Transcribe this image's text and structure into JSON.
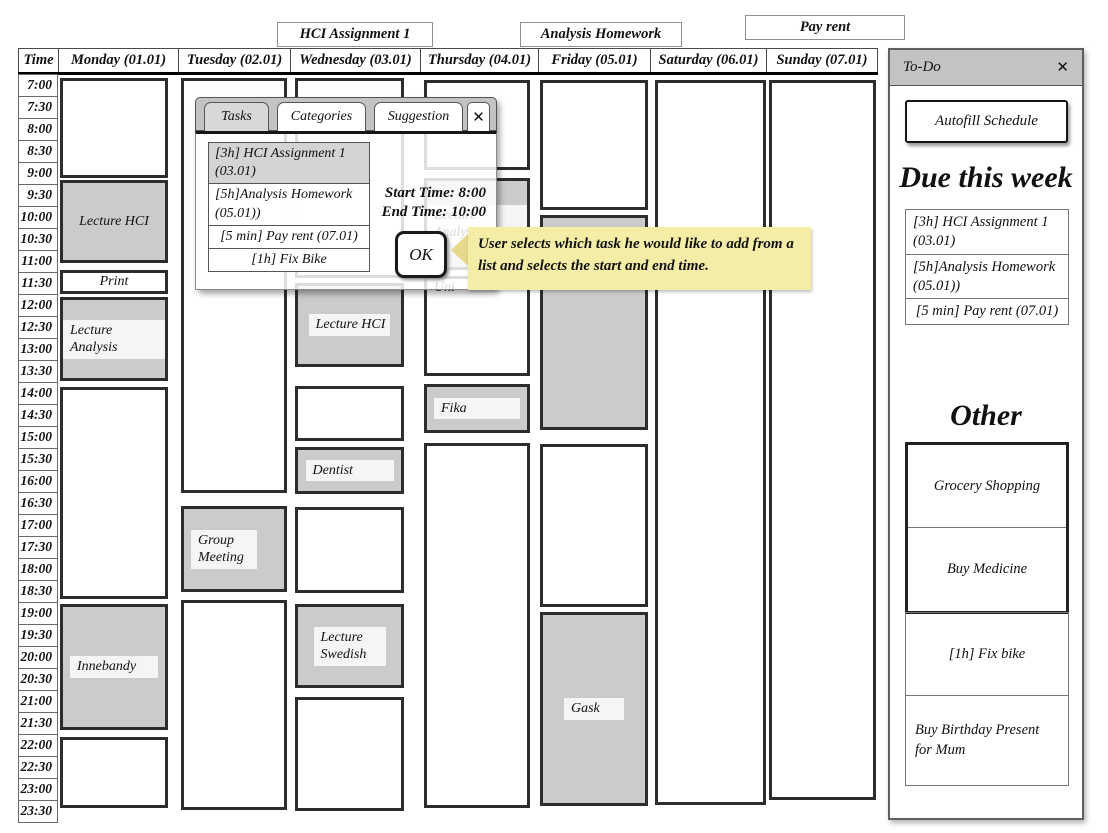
{
  "floating_labels": [
    {
      "text": "HCI Assignment 1"
    },
    {
      "text": "Analysis Homework"
    },
    {
      "text": "Pay rent"
    }
  ],
  "calendar": {
    "time_header": "Time",
    "day_headers": [
      "Monday (01.01)",
      "Tuesday (02.01)",
      "Wednesday (03.01)",
      "Thursday (04.01)",
      "Friday (05.01)",
      "Saturday (06.01)",
      "Sunday (07.01)"
    ],
    "times": [
      "7:00",
      "7:30",
      "8:00",
      "8:30",
      "9:00",
      "9:30",
      "10:00",
      "10:30",
      "11:00",
      "11:30",
      "12:00",
      "12:30",
      "13:00",
      "13:30",
      "14:00",
      "14:30",
      "15:00",
      "15:30",
      "16:00",
      "16:30",
      "17:00",
      "17:30",
      "18:00",
      "18:30",
      "19:00",
      "19:30",
      "20:00",
      "20:30",
      "21:00",
      "21:30",
      "22:00",
      "22:30",
      "23:00",
      "23:30"
    ],
    "events": [
      {
        "col": 0,
        "top": 78,
        "height": 100,
        "kind": "free"
      },
      {
        "col": 0,
        "top": 180,
        "height": 83,
        "kind": "busy",
        "label": "Lecture HCI"
      },
      {
        "col": 0,
        "top": 270,
        "height": 24,
        "kind": "free",
        "label": "Print"
      },
      {
        "col": 0,
        "top": 297,
        "height": 84,
        "kind": "busy",
        "label": "Lecture Analysis",
        "strip": true
      },
      {
        "col": 0,
        "top": 387,
        "height": 212,
        "kind": "free"
      },
      {
        "col": 0,
        "top": 604,
        "height": 126,
        "kind": "busy",
        "label": "Innebandy",
        "strip": true,
        "strip_w": 88
      },
      {
        "col": 0,
        "top": 737,
        "height": 71,
        "kind": "free"
      },
      {
        "col": 1,
        "top": 78,
        "height": 415,
        "kind": "free"
      },
      {
        "col": 1,
        "top": 506,
        "height": 86,
        "kind": "busy",
        "label": "Group Meeting",
        "strip": true,
        "strip_w": 66,
        "align": "left"
      },
      {
        "col": 1,
        "top": 600,
        "height": 210,
        "kind": "free"
      },
      {
        "col": 2,
        "top": 78,
        "height": 200,
        "kind": "free"
      },
      {
        "col": 2,
        "top": 283,
        "height": 84,
        "kind": "busy",
        "label": "Lecture HCI",
        "strip": true
      },
      {
        "col": 2,
        "top": 386,
        "height": 55,
        "kind": "free"
      },
      {
        "col": 2,
        "top": 447,
        "height": 47,
        "kind": "busy",
        "label": "Dentist",
        "strip": true,
        "strip_w": 88
      },
      {
        "col": 2,
        "top": 507,
        "height": 86,
        "kind": "free"
      },
      {
        "col": 2,
        "top": 604,
        "height": 84,
        "kind": "busy",
        "label": "Lecture Swedish",
        "strip": true,
        "strip_w": 72
      },
      {
        "col": 2,
        "top": 697,
        "height": 114,
        "kind": "free"
      },
      {
        "col": 3,
        "top": 80,
        "height": 90,
        "kind": "free"
      },
      {
        "col": 3,
        "top": 178,
        "height": 92,
        "kind": "busy",
        "label": "Lecture Analysis",
        "strip": true
      },
      {
        "col": 3,
        "top": 276,
        "height": 100,
        "kind": "free",
        "label": "Uni",
        "valign": "top",
        "align": "left"
      },
      {
        "col": 3,
        "top": 384,
        "height": 49,
        "kind": "busy",
        "label": "Fika",
        "strip": true,
        "strip_w": 86
      },
      {
        "col": 3,
        "top": 443,
        "height": 365,
        "kind": "free"
      },
      {
        "col": 4,
        "top": 80,
        "height": 130,
        "kind": "free"
      },
      {
        "col": 4,
        "top": 215,
        "height": 215,
        "kind": "busy"
      },
      {
        "col": 4,
        "top": 444,
        "height": 163,
        "kind": "free"
      },
      {
        "col": 4,
        "top": 612,
        "height": 194,
        "kind": "busy",
        "label": "Gask",
        "strip": true,
        "strip_w": 60
      },
      {
        "col": 5,
        "top": 80,
        "height": 725,
        "kind": "free"
      },
      {
        "col": 6,
        "top": 80,
        "height": 720,
        "kind": "free"
      }
    ]
  },
  "popup": {
    "tabs": [
      "Tasks",
      "Categories",
      "Suggestion"
    ],
    "active_tab": "Tasks",
    "close_glyph": "✕",
    "tasks": [
      "[3h] HCI Assignment 1 (03.01)",
      "[5h]Analysis Homework (05.01))",
      "[5 min] Pay rent (07.01)",
      "[1h] Fix Bike"
    ],
    "start_time": "Start Time: 8:00",
    "end_time": "End Time: 10:00",
    "ok_label": "OK"
  },
  "tooltip": {
    "text": "User selects which task he would like to add from a list and selects the start and end time."
  },
  "todo_panel": {
    "title": "To-Do",
    "close_glyph": "✕",
    "autofill_button": "Autofill Schedule",
    "due_heading": "Due this week",
    "due_items": [
      "[3h] HCI Assignment 1 (03.01)",
      "[5h]Analysis Homework (05.01))",
      "[5 min] Pay rent (07.01)"
    ],
    "other_heading": "Other",
    "other_group_items": [
      "Grocery Shopping",
      "Buy Medicine"
    ],
    "other_items": [
      "[1h] Fix bike",
      "Buy Birthday Present for Mum"
    ]
  },
  "colors": {
    "busy_event_fill": "#cbcbcb",
    "event_border": "#2d2d2d",
    "titlebar_gray": "#c3c3c3",
    "selected_row_gray": "#d4d4d4",
    "tooltip_yellow": "#f4eda6",
    "label_strip": "#f5f5f5"
  }
}
